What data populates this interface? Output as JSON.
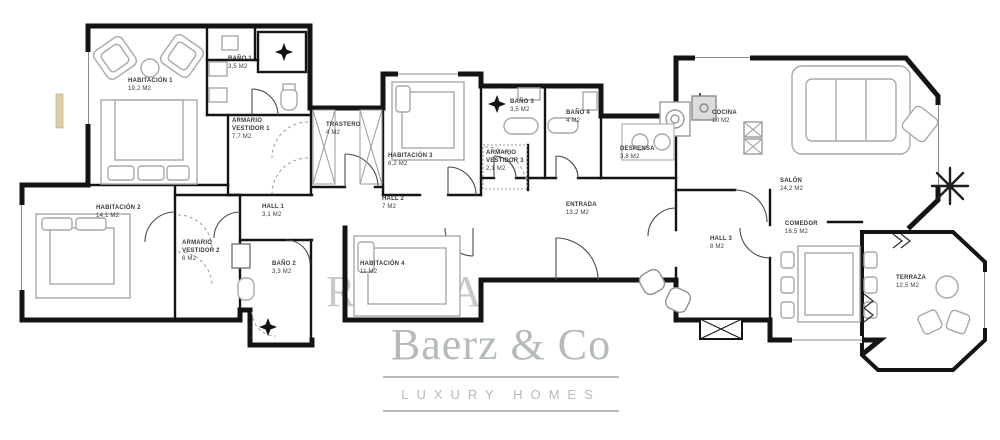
{
  "plan": {
    "rooms": [
      {
        "name": "HABITACIÓN 1",
        "area": "19,2 m2"
      },
      {
        "name": "BAÑO 1",
        "area": "3,5 m2"
      },
      {
        "name": "ARMARIO VESTIDOR 1",
        "area": "7,7 m2"
      },
      {
        "name": "TRASTERO",
        "area": "4 m2"
      },
      {
        "name": "HABITACIÓN 3",
        "area": "8,2 m2"
      },
      {
        "name": "BAÑO 3",
        "area": "3,5 m2"
      },
      {
        "name": "BAÑO 4",
        "area": "4 m2"
      },
      {
        "name": "ARMARIO VESTIDOR 3",
        "area": "2,1 m2"
      },
      {
        "name": "DESPENSA",
        "area": "3,8 m2"
      },
      {
        "name": "COCINA",
        "area": "10 m2"
      },
      {
        "name": "SALÓN",
        "area": "24,2 M2"
      },
      {
        "name": "HABITACIÓN 2",
        "area": "14,1 m2"
      },
      {
        "name": "ARMARIO VESTIDOR 2",
        "area": "6 m2"
      },
      {
        "name": "BAÑO 2",
        "area": "3,3 m2"
      },
      {
        "name": "HALL 1",
        "area": "3,1 m2"
      },
      {
        "name": "HALL 2",
        "area": "7 m2"
      },
      {
        "name": "HABITACIÓN 4",
        "area": "11 m2"
      },
      {
        "name": "ENTRADA",
        "area": "13,2 m2"
      },
      {
        "name": "HALL 3",
        "area": "8 m2"
      },
      {
        "name": "COMEDOR",
        "area": "16,5 M2"
      },
      {
        "name": "TERRAZA",
        "area": "12,5 m2"
      }
    ]
  },
  "watermark": {
    "brand": "Baerz & Co",
    "tagline": "LUXURY HOMES",
    "fragments": [
      "R",
      "by",
      "A"
    ]
  },
  "icons": {
    "shower-icon": "4-point diamond star",
    "plant-icon": "radial line palm",
    "stove-icon": "concentric circle burner",
    "appliance-icon": "circle drum",
    "elevator-icon": "crossed box"
  },
  "colors": {
    "wall": "#141414",
    "furniture": "#a9a9a9",
    "watermark": "#b5bbba",
    "sill_accent": "#d9d0a9",
    "label_text": "#3a3a3a"
  }
}
